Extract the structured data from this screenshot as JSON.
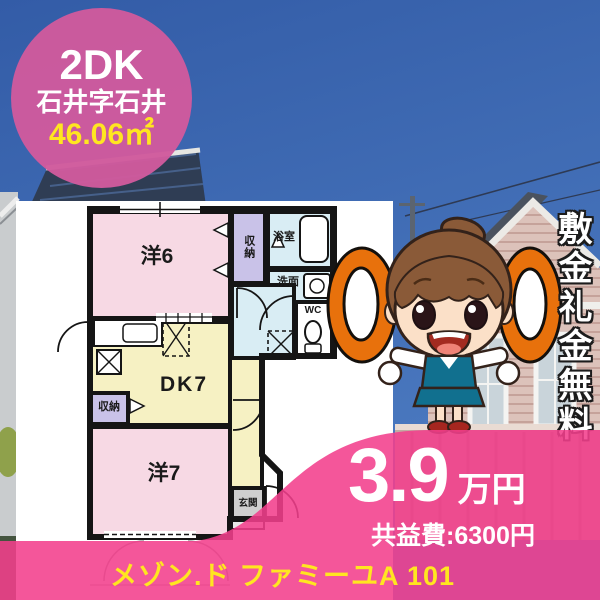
{
  "badge": {
    "layout": "2DK",
    "address": "石井字石井",
    "area": "46.06㎡"
  },
  "floorplan": {
    "rooms": [
      {
        "key": "western-room-6",
        "label": "洋6"
      },
      {
        "key": "closet-upper",
        "label": "収納"
      },
      {
        "key": "bathroom",
        "label": "浴室"
      },
      {
        "key": "washroom",
        "label": "洗面"
      },
      {
        "key": "toilet",
        "label": "WC"
      },
      {
        "key": "dining-kitchen",
        "label": "DK7"
      },
      {
        "key": "closet-lower",
        "label": "収納"
      },
      {
        "key": "western-room-7",
        "label": "洋7"
      },
      {
        "key": "entrance",
        "label": "玄関"
      }
    ]
  },
  "promo": {
    "ribbon": "敷金礼金無料"
  },
  "price": {
    "rent": "3.9",
    "rent_unit": "万円",
    "common_fee": "共益費:6300円"
  },
  "footer": {
    "property_name": "メゾン.ド ファミーユA 101"
  },
  "colors": {
    "accent_pink": "#f23f8c",
    "badge_pink": "#d05a9d",
    "highlight_yellow": "#ffe620",
    "ok_orange": "#e8710c",
    "sky_blue": "#3b66ae"
  }
}
